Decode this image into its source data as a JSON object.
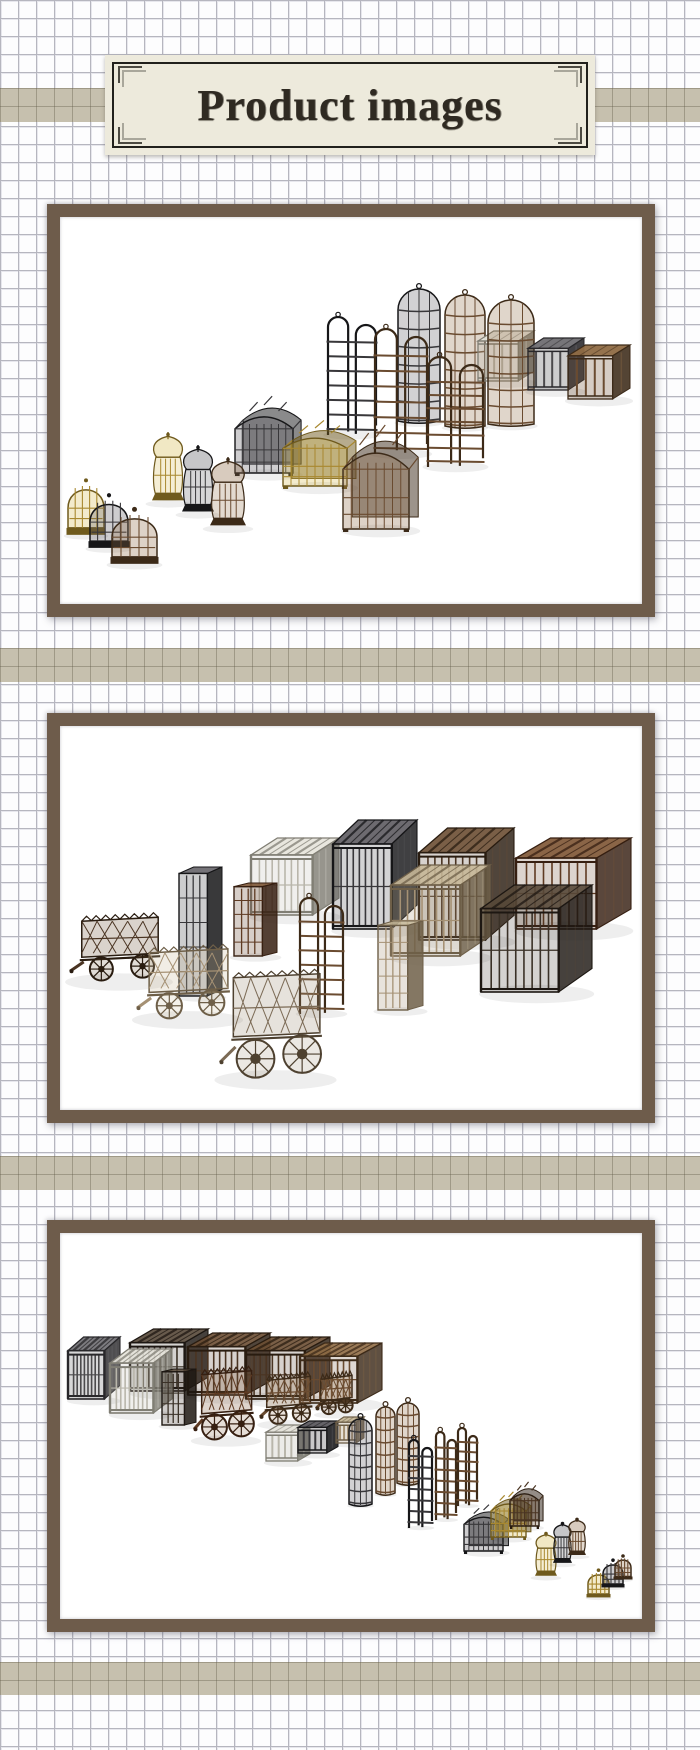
{
  "header": {
    "title": "Product images"
  },
  "theme": {
    "page_bg": "#fdfdfe",
    "grid_line_color": "#b6b6bf",
    "band_color": "#c6c0ae",
    "frame_color": "#6e5c4b",
    "header_bg": "#edeadc",
    "header_border_color": "#21201c",
    "title_color": "#2f2a22"
  },
  "palette": {
    "gold": {
      "base": "#a8882f",
      "dark": "#6f5a1d",
      "light": "#d6bc55"
    },
    "black": {
      "base": "#38373a",
      "dark": "#161618",
      "light": "#5d5b60"
    },
    "brown": {
      "base": "#6a4b30",
      "dark": "#3c2a18",
      "light": "#8f6b45"
    },
    "darkbrown": {
      "base": "#4a3422",
      "dark": "#291c10",
      "light": "#6b4e33"
    },
    "redbrown": {
      "base": "#5e3a22",
      "dark": "#361f11",
      "light": "#7d5433"
    },
    "tan": {
      "base": "#a59174",
      "dark": "#6e5f48",
      "light": "#c6b798"
    },
    "silver": {
      "base": "#b9b6ab",
      "dark": "#807e74",
      "light": "#e5e3da"
    },
    "darkgray": {
      "base": "#4b4a4c",
      "dark": "#28272a",
      "light": "#6f6e72"
    },
    "verydark": {
      "base": "#3a3127",
      "dark": "#1d1712",
      "light": "#564838"
    },
    "graybrown": {
      "base": "#7b6a55",
      "dark": "#4e4130",
      "light": "#9c8b72"
    }
  },
  "figures": [
    {
      "name": "product-image-1",
      "description": "Bird cage set: dome cages, lantern cages, house cages, hanging gibbet frames, tall cylinder cages and slat crates arranged diagonally",
      "items": [
        {
          "type": "cylinder",
          "color": "black",
          "x": 338,
          "y": 72,
          "w": 42,
          "h": 134
        },
        {
          "type": "cylinder",
          "color": "brown",
          "x": 385,
          "y": 78,
          "w": 40,
          "h": 133
        },
        {
          "type": "crate",
          "color": "silver",
          "x": 418,
          "y": 114,
          "w": 56,
          "h": 50
        },
        {
          "type": "cylinder",
          "color": "brown",
          "x": 428,
          "y": 83,
          "w": 46,
          "h": 126
        },
        {
          "type": "crate",
          "color": "darkgray",
          "x": 468,
          "y": 121,
          "w": 56,
          "h": 52
        },
        {
          "type": "crate",
          "color": "brown",
          "x": 508,
          "y": 128,
          "w": 62,
          "h": 54
        },
        {
          "type": "gibbet",
          "color": "black",
          "x": 268,
          "y": 100,
          "w": 48,
          "h": 118
        },
        {
          "type": "gibbet",
          "color": "brown",
          "x": 315,
          "y": 112,
          "w": 52,
          "h": 125
        },
        {
          "type": "gibbet",
          "color": "brown",
          "x": 368,
          "y": 140,
          "w": 55,
          "h": 110
        },
        {
          "type": "house",
          "color": "black",
          "x": 175,
          "y": 188,
          "w": 58,
          "h": 68
        },
        {
          "type": "house",
          "color": "gold",
          "x": 223,
          "y": 211,
          "w": 64,
          "h": 58
        },
        {
          "type": "house",
          "color": "brown",
          "x": 283,
          "y": 220,
          "w": 66,
          "h": 92
        },
        {
          "type": "lantern",
          "color": "gold",
          "x": 92,
          "y": 215,
          "w": 32,
          "h": 72
        },
        {
          "type": "lantern",
          "color": "black",
          "x": 122,
          "y": 228,
          "w": 32,
          "h": 70
        },
        {
          "type": "lantern",
          "color": "brown",
          "x": 150,
          "y": 240,
          "w": 36,
          "h": 72
        },
        {
          "type": "dome",
          "color": "gold",
          "x": 8,
          "y": 261,
          "w": 36,
          "h": 58
        },
        {
          "type": "dome",
          "color": "black",
          "x": 30,
          "y": 276,
          "w": 38,
          "h": 56
        },
        {
          "type": "dome",
          "color": "brown",
          "x": 52,
          "y": 290,
          "w": 45,
          "h": 58
        }
      ]
    },
    {
      "name": "product-image-2",
      "description": "Prison cage set: large slat-roof box cages, tall narrow cages, arched frame and three spiked cage wagons with wheels",
      "items": [
        {
          "type": "bigbox",
          "color": "silver",
          "x": 191,
          "y": 112,
          "w": 88,
          "h": 77
        },
        {
          "type": "bigbox",
          "color": "black",
          "x": 273,
          "y": 94,
          "w": 84,
          "h": 109
        },
        {
          "type": "bigbox",
          "color": "darkbrown",
          "x": 359,
          "y": 102,
          "w": 95,
          "h": 112
        },
        {
          "type": "bigbox",
          "color": "redbrown",
          "x": 456,
          "y": 112,
          "w": 115,
          "h": 91
        },
        {
          "type": "bigbox",
          "color": "tan",
          "x": 331,
          "y": 139,
          "w": 99,
          "h": 91
        },
        {
          "type": "bigbox",
          "color": "verydark",
          "x": 421,
          "y": 159,
          "w": 111,
          "h": 107
        },
        {
          "type": "tallbox",
          "color": "black",
          "x": 119,
          "y": 141,
          "w": 43,
          "h": 129
        },
        {
          "type": "tallbox",
          "color": "redbrown",
          "x": 174,
          "y": 157,
          "w": 43,
          "h": 73
        },
        {
          "type": "gibbet",
          "color": "brown",
          "x": 240,
          "y": 172,
          "w": 43,
          "h": 116
        },
        {
          "type": "tallbox",
          "color": "tan",
          "x": 318,
          "y": 195,
          "w": 45,
          "h": 89
        },
        {
          "type": "wagon",
          "color": "darkbrown",
          "x": 10,
          "y": 184,
          "w": 98,
          "h": 72
        },
        {
          "type": "wagon",
          "color": "tan",
          "x": 77,
          "y": 215,
          "w": 101,
          "h": 79
        },
        {
          "type": "wagon",
          "color": "graybrown",
          "x": 160,
          "y": 236,
          "w": 111,
          "h": 118
        }
      ]
    },
    {
      "name": "product-image-3",
      "description": "Full collection rear view: large box cages and wagons at left shrinking diagonally to crates, cylinder cages, gibbets, house cages, lantern cages and dome cages at right",
      "items": [
        {
          "type": "bigbox",
          "color": "verydark",
          "x": 70,
          "y": 96,
          "w": 78,
          "h": 62
        },
        {
          "type": "bigbox",
          "color": "darkbrown",
          "x": 128,
          "y": 100,
          "w": 82,
          "h": 62
        },
        {
          "type": "bigbox",
          "color": "darkbrown",
          "x": 186,
          "y": 104,
          "w": 84,
          "h": 62
        },
        {
          "type": "bigbox",
          "color": "brown",
          "x": 240,
          "y": 110,
          "w": 82,
          "h": 60
        },
        {
          "type": "bigbox",
          "color": "darkgray",
          "x": 8,
          "y": 104,
          "w": 52,
          "h": 62
        },
        {
          "type": "bigbox",
          "color": "silver",
          "x": 50,
          "y": 116,
          "w": 62,
          "h": 64
        },
        {
          "type": "tallbox",
          "color": "verydark",
          "x": 102,
          "y": 136,
          "w": 34,
          "h": 56
        },
        {
          "type": "wagon",
          "color": "redbrown",
          "x": 134,
          "y": 130,
          "w": 64,
          "h": 78
        },
        {
          "type": "wagon",
          "color": "brown",
          "x": 200,
          "y": 138,
          "w": 56,
          "h": 54
        },
        {
          "type": "wagon",
          "color": "brown",
          "x": 256,
          "y": 138,
          "w": 40,
          "h": 44
        },
        {
          "type": "crate",
          "color": "silver",
          "x": 206,
          "y": 192,
          "w": 44,
          "h": 36
        },
        {
          "type": "crate",
          "color": "black",
          "x": 238,
          "y": 188,
          "w": 40,
          "h": 32
        },
        {
          "type": "crate",
          "color": "tan",
          "x": 276,
          "y": 184,
          "w": 28,
          "h": 26
        },
        {
          "type": "cylinder",
          "color": "black",
          "x": 289,
          "y": 186,
          "w": 23,
          "h": 87
        },
        {
          "type": "cylinder",
          "color": "brown",
          "x": 316,
          "y": 174,
          "w": 19,
          "h": 88
        },
        {
          "type": "cylinder",
          "color": "brown",
          "x": 337,
          "y": 170,
          "w": 22,
          "h": 82
        },
        {
          "type": "gibbet",
          "color": "black",
          "x": 349,
          "y": 207,
          "w": 23,
          "h": 88
        },
        {
          "type": "gibbet",
          "color": "brown",
          "x": 376,
          "y": 199,
          "w": 20,
          "h": 88
        },
        {
          "type": "gibbet",
          "color": "brown",
          "x": 398,
          "y": 195,
          "w": 19,
          "h": 78
        },
        {
          "type": "house",
          "color": "black",
          "x": 404,
          "y": 277,
          "w": 39,
          "h": 41
        },
        {
          "type": "house",
          "color": "gold",
          "x": 431,
          "y": 264,
          "w": 35,
          "h": 40
        },
        {
          "type": "house",
          "color": "darkbrown",
          "x": 450,
          "y": 254,
          "w": 29,
          "h": 39
        },
        {
          "type": "lantern",
          "color": "gold",
          "x": 475,
          "y": 299,
          "w": 22,
          "h": 46
        },
        {
          "type": "lantern",
          "color": "black",
          "x": 493,
          "y": 289,
          "w": 19,
          "h": 43
        },
        {
          "type": "lantern",
          "color": "brown",
          "x": 508,
          "y": 285,
          "w": 18,
          "h": 39
        },
        {
          "type": "dome",
          "color": "gold",
          "x": 528,
          "y": 336,
          "w": 21,
          "h": 29
        },
        {
          "type": "dome",
          "color": "black",
          "x": 543,
          "y": 326,
          "w": 20,
          "h": 29
        },
        {
          "type": "dome",
          "color": "brown",
          "x": 555,
          "y": 322,
          "w": 16,
          "h": 25
        }
      ]
    }
  ]
}
